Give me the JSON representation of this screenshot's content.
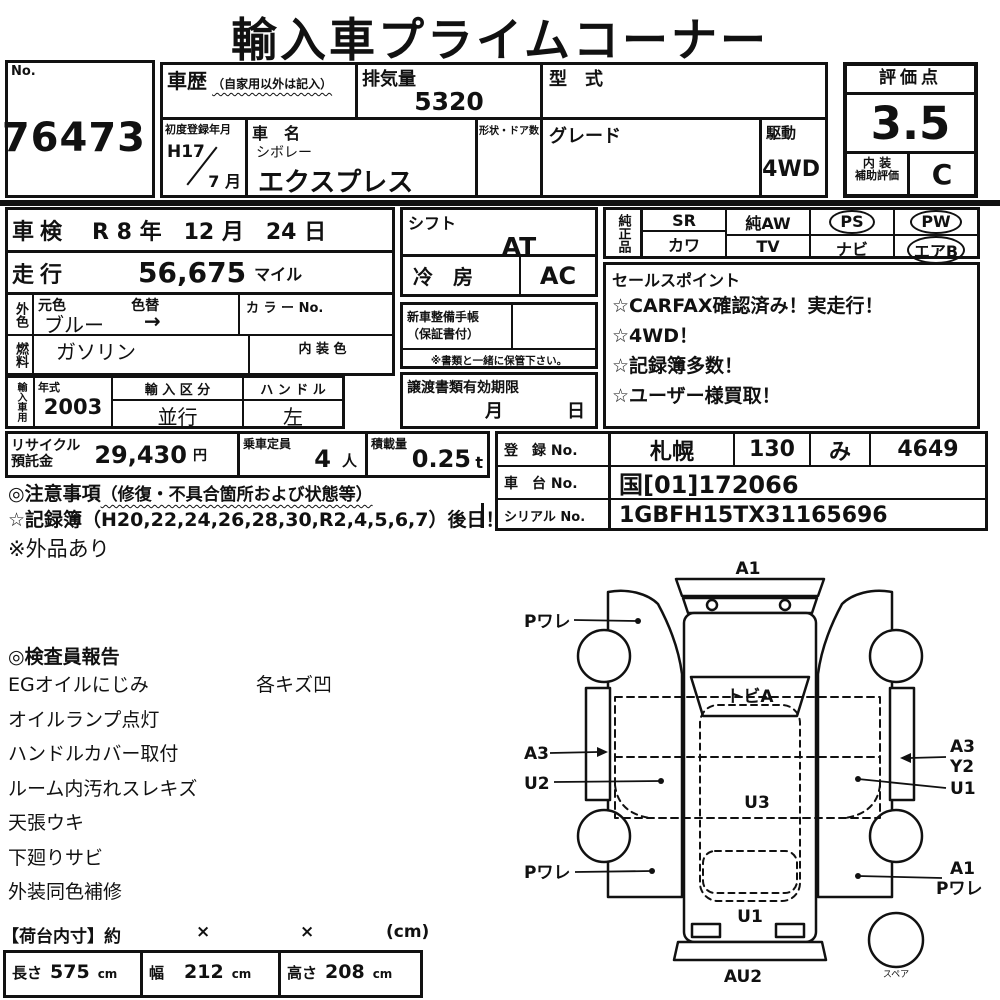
{
  "title": "輸入車プライムコーナー",
  "colors": {
    "ink": "#111111",
    "paper": "#ffffff"
  },
  "no_box": {
    "label": "No.",
    "value": "76473"
  },
  "spec": {
    "history_label": "車歴",
    "history_note": "（自家用以外は記入）",
    "displacement_label": "排気量",
    "displacement": "5320",
    "model_code_label": "型　式",
    "first_reg_label": "初度登録年月",
    "first_reg_year": "H17",
    "first_reg_month": "7 月",
    "name_label": "車　名",
    "maker": "シボレー",
    "model": "エクスプレス",
    "shape_label": "形状・ドア数",
    "grade_label": "グレード",
    "drive_label": "駆動",
    "drive": "4WD"
  },
  "score": {
    "label": "評価点",
    "value": "3.5",
    "interior_label": "内 装",
    "interior_sublabel": "補助評価",
    "interior": "C"
  },
  "left": {
    "shaken_label": "車検",
    "shaken": "R 8 年　12 月　24 日",
    "mileage_label": "走行",
    "mileage": "56,675",
    "mileage_unit": "マイル",
    "ext_color_label": "外色",
    "orig_color_label": "元色",
    "orig_color": "ブルー",
    "recolor_label": "色替",
    "recolor": "→",
    "color_no_label": "カ ラ ー No.",
    "fuel_label": "燃料",
    "fuel": "ガソリン",
    "int_color_label": "内 装 色",
    "import_label": "輸入車用",
    "year_label": "年式",
    "year": "2003",
    "import_class_label": "輸 入 区 分",
    "import_class": "並行",
    "steering_label": "ハ ン ド ル",
    "steering": "左"
  },
  "mid": {
    "shift_label": "シフト",
    "shift": "AT",
    "ac_label": "冷　房",
    "ac": "AC",
    "book_label": "新車整備手帳",
    "book_sub": "（保証書付）",
    "book_note": "※書類と一緒に保管下さい。",
    "transfer_label": "譲渡書類有効期限",
    "transfer_month": "月",
    "transfer_day": "日"
  },
  "equipment": {
    "header": "純正品",
    "row1": [
      "SR",
      "純AW",
      "PS",
      "PW"
    ],
    "row2": [
      "カワ",
      "TV",
      "ナビ",
      "エアB"
    ],
    "circled": [
      "PS",
      "PW",
      "エアB"
    ]
  },
  "sales_points": {
    "title": "セールスポイント",
    "items": [
      "☆CARFAX確認済み！実走行！",
      "☆4WD！",
      "☆記録簿多数！",
      "☆ユーザー様買取！"
    ]
  },
  "recycle": {
    "label1": "リサイクル",
    "label2": "預託金",
    "value": "29,430",
    "unit": "円"
  },
  "capacity": {
    "label": "乗車定員",
    "value": "4",
    "unit": "人"
  },
  "load": {
    "label": "積載量",
    "value": "0.25",
    "unit": "t"
  },
  "registration": {
    "reg_label": "登　録 No.",
    "reg_area": "札幌",
    "reg_class": "130",
    "reg_kana": "み",
    "reg_num": "4649",
    "chassis_label": "車　台 No.",
    "chassis": "国[01]172066",
    "serial_label": "シリアル No.",
    "serial": "1GBFH15TX31165696"
  },
  "notes": {
    "caution": "◎注意事項",
    "caution_note": "（修復・不具合箇所および状態等）",
    "record": "☆記録簿（H20,22,24,26,28,30,R2,4,5,6,7）後日！",
    "aftermarket": "※外品あり"
  },
  "inspector": {
    "title": "◎検査員報告",
    "col1": [
      "EGオイルにじみ",
      "オイルランプ点灯",
      "ハンドルカバー取付",
      "ルーム内汚れスレキズ",
      "天張ウキ",
      "下廻りサビ",
      "外装同色補修"
    ],
    "col2": [
      "各キズ凹"
    ]
  },
  "cargo": {
    "header": "【荷台内寸】約",
    "x1": "×",
    "x2": "×",
    "unit": "(cm)",
    "length_label": "長さ",
    "length": "575",
    "length_unit": "cm",
    "width_label": "幅",
    "width": "212",
    "width_unit": "cm",
    "height_label": "高さ",
    "height": "208",
    "height_unit": "cm"
  },
  "diagram": {
    "labels": {
      "a1_top": "A1",
      "p_ware_tl": "Pワレ",
      "a3_left": "A3",
      "u2_left": "U2",
      "p_ware_bl": "Pワレ",
      "tobi_a": "トビA",
      "u3": "U3",
      "u1_center": "U1",
      "au2": "AU2",
      "a3_right": "A3",
      "y2_right": "Y2",
      "u1_right": "U1",
      "a1_br": "A1",
      "p_ware_br": "Pワレ",
      "spare": "スペア"
    }
  }
}
